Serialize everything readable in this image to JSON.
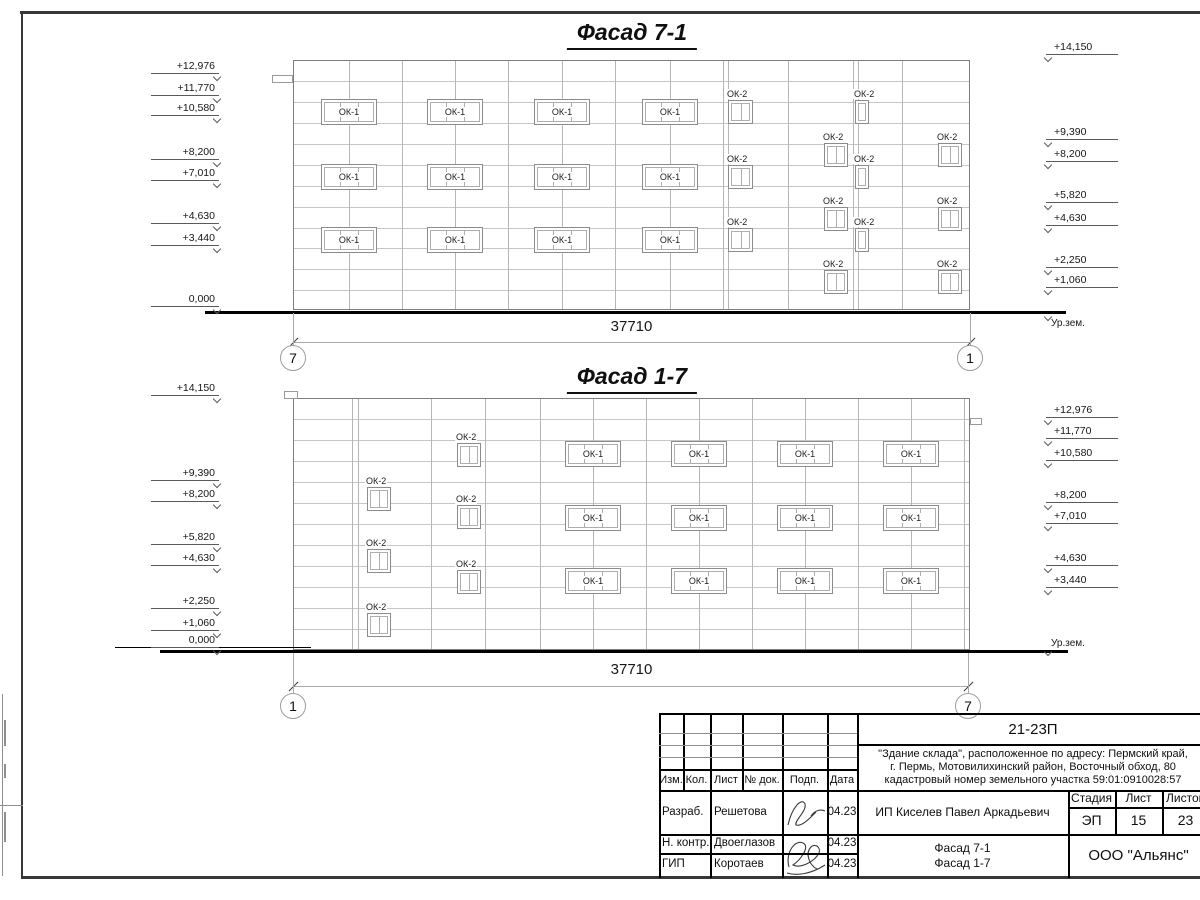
{
  "facades": {
    "top": {
      "title": "Фасад 7-1",
      "dimension": "37710",
      "axis_left": "7",
      "axis_right": "1",
      "ground_label": "Ур.зем.",
      "window_label_wide": "ОК-1",
      "window_label_small": "ОК-2",
      "marks_left": [
        "+12,976",
        "+11,770",
        "+10,580",
        "+8,200",
        "+7,010",
        "+4,630",
        "+3,440",
        "0,000"
      ],
      "marks_right": [
        "+14,150",
        "+9,390",
        "+8,200",
        "+5,820",
        "+4,630",
        "+2,250",
        "+1,060"
      ]
    },
    "bottom": {
      "title": "Фасад 1-7",
      "dimension": "37710",
      "axis_left": "1",
      "axis_right": "7",
      "ground_label": "Ур.зем.",
      "window_label_wide": "ОК-1",
      "window_label_small": "ОК-2",
      "marks_left": [
        "+14,150",
        "+9,390",
        "+8,200",
        "+5,820",
        "+4,630",
        "+2,250",
        "+1,060",
        "0,000"
      ],
      "marks_right": [
        "+12,976",
        "+11,770",
        "+10,580",
        "+8,200",
        "+7,010",
        "+4,630",
        "+3,440"
      ]
    }
  },
  "titleblock": {
    "project_code": "21-23П",
    "address_lines": [
      "\"Здание склада\", расположенное по адресу: Пермский край,",
      "г. Пермь, Мотовилихинский район, Восточный обход, 80",
      "кадастровый номер земельного участка 59:01:0910028:57"
    ],
    "columns": [
      "Изм.",
      "Кол.",
      "Лист",
      "№ док.",
      "Подп.",
      "Дата"
    ],
    "signature_rows": [
      {
        "role": "Разраб.",
        "name": "Решетова",
        "date": "04.23"
      },
      {
        "role": "Н. контр.",
        "name": "Двоеглазов",
        "date": "04.23"
      },
      {
        "role": "ГИП",
        "name": "Коротаев",
        "date": "04.23"
      }
    ],
    "client": "ИП Киселев Павел Аркадьевич",
    "stage_label": "Стадия",
    "sheet_label": "Лист",
    "sheets_label": "Листов",
    "stage": "ЭП",
    "sheet_number": "15",
    "sheets_total": "23",
    "drawing_titles": [
      "Фасад 7-1",
      "Фасад 1-7"
    ],
    "organization": "ООО \"Альянс\""
  }
}
